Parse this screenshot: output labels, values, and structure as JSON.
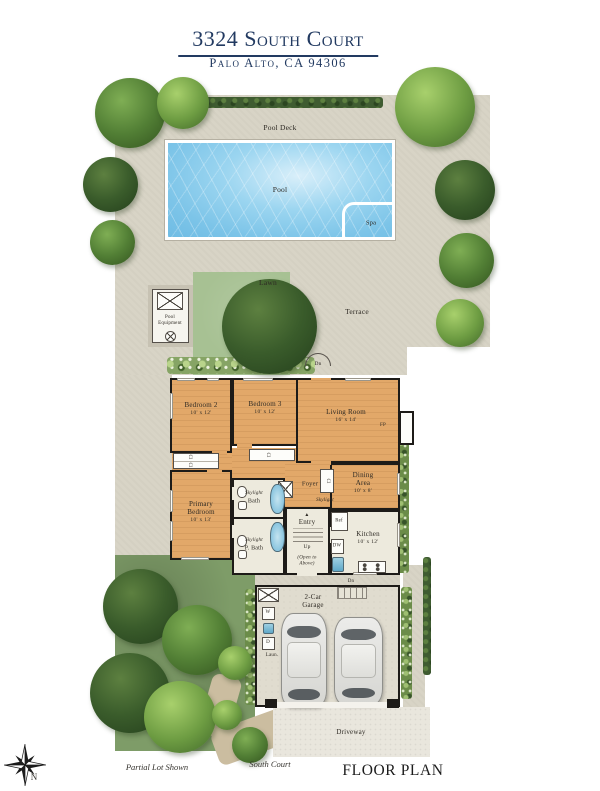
{
  "header": {
    "title": "3324 South Court",
    "subtitle": "Palo Alto, CA 94306"
  },
  "site": {
    "pool_deck": "Pool Deck",
    "pool": "Pool",
    "spa": "Spa",
    "lawn": "Lawn",
    "terrace": "Terrace",
    "pool_equipment": "Pool Equipment",
    "driveway": "Driveway"
  },
  "rooms": {
    "bedroom2": {
      "name": "Bedroom 2",
      "dims": "10' x 12'"
    },
    "bedroom3": {
      "name": "Bedroom 3",
      "dims": "10' x 12'"
    },
    "living": {
      "name": "Living Room",
      "dims": "16' x 14'"
    },
    "dining": {
      "name": "Dining Area",
      "dims": "10' x 8'"
    },
    "primary": {
      "name": "Primary Bedroom",
      "dims": "10' x 13'"
    },
    "kitchen": {
      "name": "Kitchen",
      "dims": "10' x 12'"
    },
    "garage": {
      "name": "2-Car Garage"
    },
    "foyer": {
      "name": "Foyer"
    },
    "bath": {
      "skylight": "Skylight",
      "name": "Bath"
    },
    "pbath": {
      "skylight": "Skylight",
      "name": "P. Bath"
    },
    "entry": {
      "name": "Entry",
      "up": "Up",
      "open": "(Open to Above)"
    }
  },
  "labels": {
    "fp": "FP",
    "cl": "Cl",
    "ref": "Ref",
    "dw": "DW",
    "dn": "Dn",
    "washer": "W",
    "dryer": "D",
    "laundry": "Laun.",
    "skylight": "Skylight"
  },
  "icons": {
    "up_arrow": "▲"
  },
  "footer": {
    "partial_lot": "Partial Lot Shown",
    "street": "South Court",
    "plan_title": "FLOOR PLAN",
    "north": "N"
  },
  "colors": {
    "navy": "#223a61",
    "pool_water": "#7cc4e8",
    "lawn": "#a7c193",
    "wood_floor": "#e2a869",
    "wall": "#1d1b18",
    "deck": "#d8d4c6",
    "tile": "#edeadd",
    "garage_floor": "#e0dccf",
    "driveway": "#e9e6dd",
    "garden": "#7e9c68",
    "tree_dark": "#3a5c2b",
    "tree_bright": "#6d9c42"
  }
}
